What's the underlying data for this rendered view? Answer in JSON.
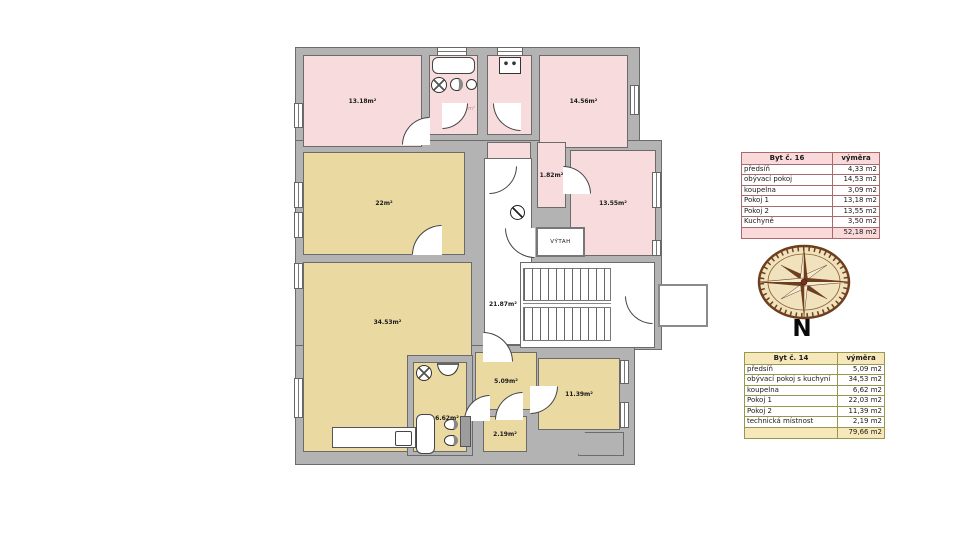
{
  "plan": {
    "labels": {
      "room_13_18": "13.18m²",
      "bath_16": "3.09m²",
      "kitchen_16": "3.50m²",
      "room_14_56": "14.56m²",
      "room_2_51": "2.51m²",
      "room_1_82": "1.82m²",
      "room_13_55": "13.55m²",
      "room_22": "22m²",
      "corridor": "21.87m²",
      "elevator": "VÝTAH",
      "room_34_53": "34.53m²",
      "bath_14": "6.62m²",
      "hall_5_09": "5.09m²",
      "tech_2_19": "2.19m²",
      "room_11_39": "11.39m²"
    },
    "colors": {
      "apartment16": "#f8dcdd",
      "apartment14": "#ead9a1",
      "wall": "#b3b3b3",
      "wall_line": "#6b6b6b"
    }
  },
  "compass": {
    "label": "N"
  },
  "tables": {
    "byt16": {
      "title": "Byt č. 16",
      "value_header": "výměra",
      "rows": [
        [
          "předsíň",
          "4,33 m2"
        ],
        [
          "obývací pokoj",
          "14,53 m2"
        ],
        [
          "koupelna",
          "3,09 m2"
        ],
        [
          "Pokoj 1",
          "13,18 m2"
        ],
        [
          "Pokoj 2",
          "13,55 m2"
        ],
        [
          "Kuchyně",
          "3,50 m2"
        ]
      ],
      "total": "52,18 m2",
      "header_bg": "#f9d9d9",
      "border": "#a86a6a"
    },
    "byt14": {
      "title": "Byt č. 14",
      "value_header": "výměra",
      "rows": [
        [
          "předsíň",
          "5,09 m2"
        ],
        [
          "obývací pokoj s kuchyní",
          "34,53 m2"
        ],
        [
          "koupelna",
          "6,62 m2"
        ],
        [
          "Pokoj 1",
          "22,03 m2"
        ],
        [
          "Pokoj 2",
          "11,39 m2"
        ],
        [
          "technická místnost",
          "2,19 m2"
        ]
      ],
      "total": "79,66 m2",
      "header_bg": "#f6e8ba",
      "border": "#97974d"
    }
  }
}
